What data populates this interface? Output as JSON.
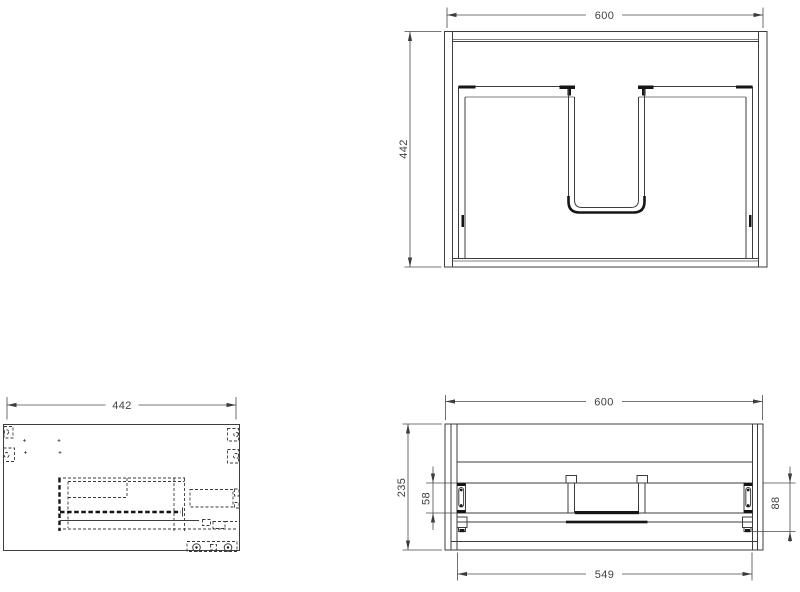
{
  "drawing": {
    "colors": {
      "background": "#ffffff",
      "line": "#3d3d3d",
      "accent_dark": "#161616"
    },
    "front_view": {
      "width_mm": "600",
      "height_mm": "442"
    },
    "side_view": {
      "depth_mm": "442"
    },
    "top_view": {
      "width_mm": "600",
      "depth_mm": "235",
      "hinge_inset_mm": "58",
      "slide_inset_mm": "88",
      "inner_width_mm": "549"
    }
  }
}
